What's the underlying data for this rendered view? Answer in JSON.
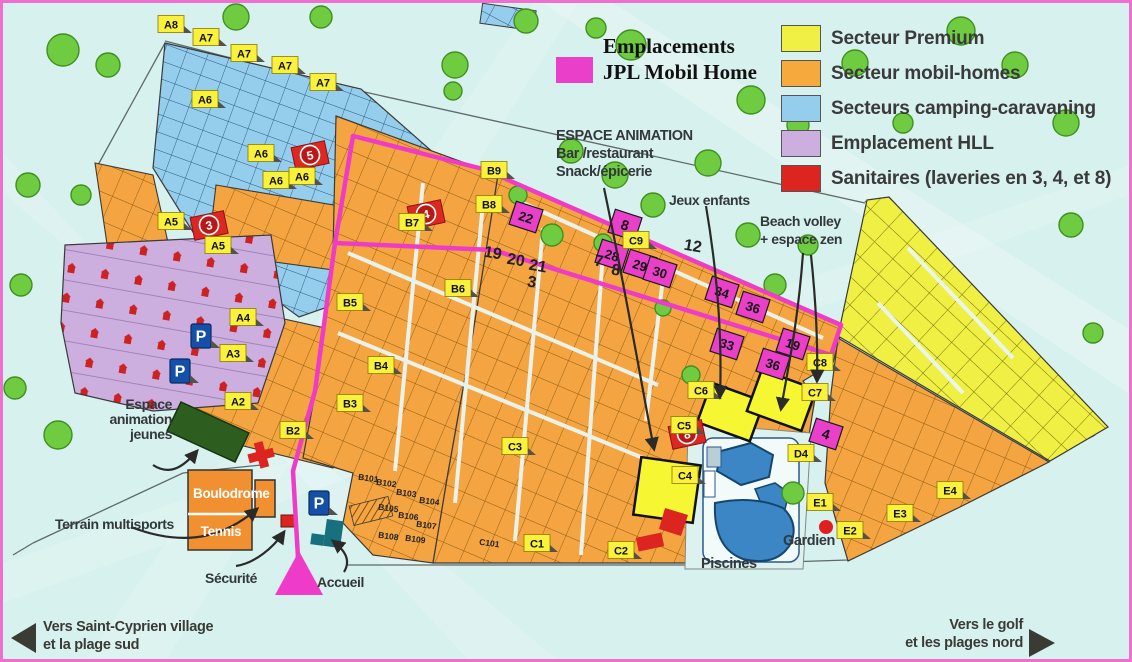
{
  "jpl_legend": {
    "swatch_color": "#e93fc9",
    "line1": "Emplacements",
    "line2": "JPL Mobil Home"
  },
  "legend": {
    "items": [
      {
        "label": "Secteur Premium",
        "color": "#eff043"
      },
      {
        "label": "Secteur mobil-homes",
        "color": "#f6a93c"
      },
      {
        "label": "Secteurs camping-caravaning",
        "color": "#95cdec"
      },
      {
        "label": "Emplacement HLL",
        "color": "#ccafdf"
      },
      {
        "label": "Sanitaires (laveries en 3, 4, et 8)",
        "color": "#dc2420"
      }
    ]
  },
  "facilities": {
    "espace_animation_line1": "ESPACE ANIMATION",
    "espace_animation_line2": "Bar /restaurant",
    "espace_animation_line3": "Snack/épicerie",
    "jeux_enfants": "Jeux enfants",
    "beach_volley_line1": "Beach volley",
    "beach_volley_line2": "+ espace zen",
    "espace_jeunes_line1": "Espace",
    "espace_jeunes_line2": "animation",
    "espace_jeunes_line3": "jeunes",
    "terrain_multisports": "Terrain multisports",
    "boulodrome": "Boulodrome",
    "tennis": "Tennis",
    "securite": "Sécurité",
    "accueil": "Accueil",
    "piscines": "Piscines",
    "gardien": "Gardien",
    "parking": "P"
  },
  "directions": {
    "sw_line1": "Vers Saint-Cyprien village",
    "sw_line2": "et la plage sud",
    "ne_line1": "Vers le golf",
    "ne_line2": "et les plages nord"
  },
  "sector_badges": [
    {
      "label": "A8",
      "x": 168,
      "y": 21
    },
    {
      "label": "A7",
      "x": 203,
      "y": 34
    },
    {
      "label": "A7",
      "x": 241,
      "y": 50
    },
    {
      "label": "A7",
      "x": 282,
      "y": 62
    },
    {
      "label": "A7",
      "x": 320,
      "y": 79
    },
    {
      "label": "A6",
      "x": 202,
      "y": 96
    },
    {
      "label": "A6",
      "x": 258,
      "y": 150
    },
    {
      "label": "A6",
      "x": 273,
      "y": 177
    },
    {
      "label": "A6",
      "x": 299,
      "y": 173
    },
    {
      "label": "A5",
      "x": 168,
      "y": 218
    },
    {
      "label": "A5",
      "x": 215,
      "y": 242
    },
    {
      "label": "A4",
      "x": 240,
      "y": 314
    },
    {
      "label": "A3",
      "x": 230,
      "y": 350
    },
    {
      "label": "A2",
      "x": 235,
      "y": 398
    },
    {
      "label": "B2",
      "x": 290,
      "y": 427
    },
    {
      "label": "B3",
      "x": 347,
      "y": 400
    },
    {
      "label": "B4",
      "x": 378,
      "y": 362
    },
    {
      "label": "B5",
      "x": 347,
      "y": 299
    },
    {
      "label": "B6",
      "x": 455,
      "y": 285
    },
    {
      "label": "B7",
      "x": 409,
      "y": 219
    },
    {
      "label": "B8",
      "x": 486,
      "y": 201
    },
    {
      "label": "B9",
      "x": 491,
      "y": 167
    },
    {
      "label": "C9",
      "x": 633,
      "y": 237
    },
    {
      "label": "C8",
      "x": 817,
      "y": 359
    },
    {
      "label": "C7",
      "x": 812,
      "y": 389
    },
    {
      "label": "C6",
      "x": 698,
      "y": 387
    },
    {
      "label": "C5",
      "x": 681,
      "y": 422
    },
    {
      "label": "C4",
      "x": 682,
      "y": 472
    },
    {
      "label": "C3",
      "x": 512,
      "y": 443
    },
    {
      "label": "C1",
      "x": 534,
      "y": 540
    },
    {
      "label": "C2",
      "x": 618,
      "y": 547
    },
    {
      "label": "D4",
      "x": 798,
      "y": 450
    },
    {
      "label": "E1",
      "x": 817,
      "y": 499
    },
    {
      "label": "E2",
      "x": 847,
      "y": 527
    },
    {
      "label": "E3",
      "x": 897,
      "y": 510
    },
    {
      "label": "E4",
      "x": 947,
      "y": 487
    }
  ],
  "sanitaires": [
    {
      "num": "5",
      "x": 307,
      "y": 152
    },
    {
      "num": "3",
      "x": 206,
      "y": 222
    },
    {
      "num": "4",
      "x": 423,
      "y": 211
    },
    {
      "num": "8",
      "x": 684,
      "y": 431
    }
  ],
  "jpl_plots": [
    {
      "label": "22",
      "x": 523,
      "y": 214
    },
    {
      "label": "8",
      "x": 622,
      "y": 222
    },
    {
      "label": "28",
      "x": 609,
      "y": 252
    },
    {
      "label": "29",
      "x": 637,
      "y": 262
    },
    {
      "label": "30",
      "x": 657,
      "y": 269
    },
    {
      "label": "34",
      "x": 719,
      "y": 289
    },
    {
      "label": "36",
      "x": 750,
      "y": 304
    },
    {
      "label": "33",
      "x": 724,
      "y": 341
    },
    {
      "label": "36",
      "x": 770,
      "y": 361
    },
    {
      "label": "19",
      "x": 790,
      "y": 341
    },
    {
      "label": "4",
      "x": 823,
      "y": 431
    }
  ],
  "big_numbers": [
    {
      "label": "19",
      "x": 489,
      "y": 255
    },
    {
      "label": "20",
      "x": 512,
      "y": 262
    },
    {
      "label": "21",
      "x": 534,
      "y": 268
    },
    {
      "label": "3",
      "x": 528,
      "y": 284
    },
    {
      "label": "7",
      "x": 595,
      "y": 263
    },
    {
      "label": "8",
      "x": 612,
      "y": 272
    },
    {
      "label": "12",
      "x": 689,
      "y": 248
    }
  ],
  "block_labels": [
    {
      "label": "B101",
      "x": 365,
      "y": 478
    },
    {
      "label": "B102",
      "x": 383,
      "y": 483
    },
    {
      "label": "B103",
      "x": 403,
      "y": 493
    },
    {
      "label": "B104",
      "x": 426,
      "y": 501
    },
    {
      "label": "B105",
      "x": 385,
      "y": 508
    },
    {
      "label": "B106",
      "x": 405,
      "y": 516
    },
    {
      "label": "B107",
      "x": 423,
      "y": 525
    },
    {
      "label": "B108",
      "x": 385,
      "y": 536
    },
    {
      "label": "B109",
      "x": 412,
      "y": 539
    },
    {
      "label": "C101",
      "x": 486,
      "y": 543
    }
  ],
  "parking_markers": [
    {
      "x": 198,
      "y": 333
    },
    {
      "x": 177,
      "y": 368
    },
    {
      "x": 316,
      "y": 500
    }
  ]
}
